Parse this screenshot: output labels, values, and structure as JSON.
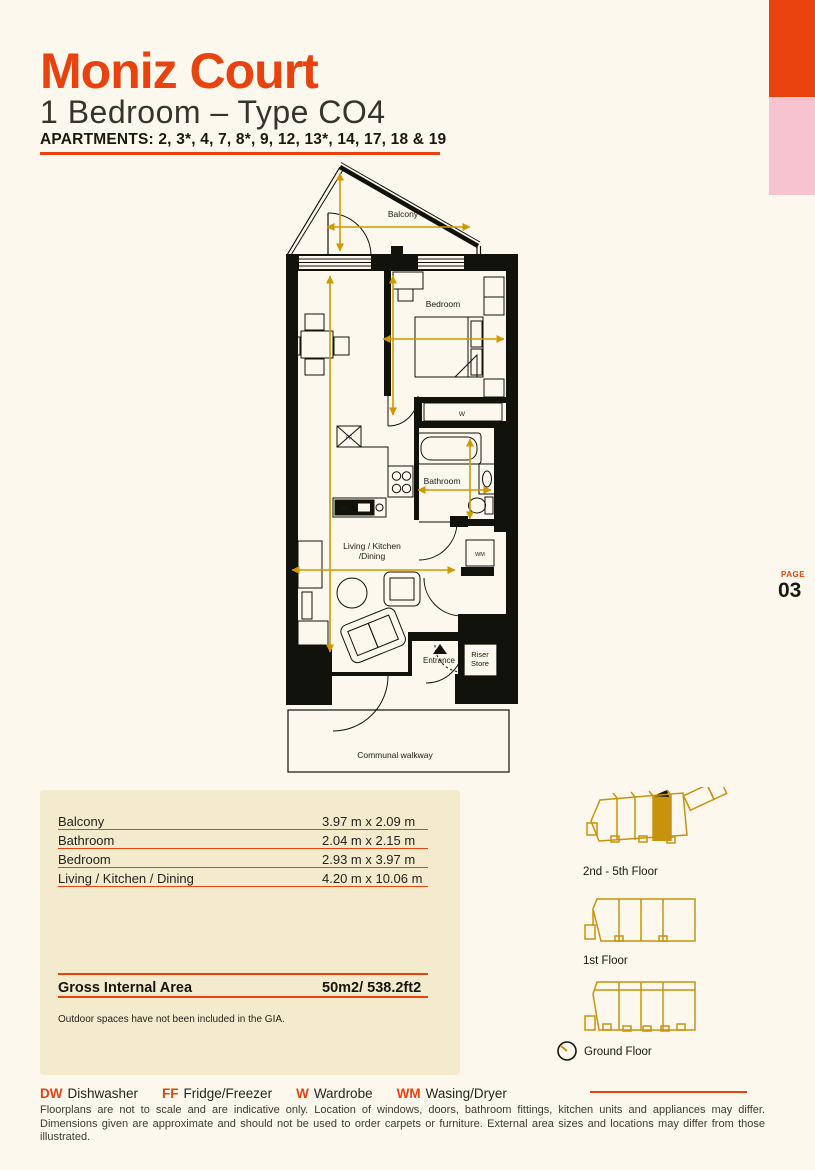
{
  "header": {
    "title": "Moniz Court",
    "subtitle": "1 Bedroom – Type CO4",
    "apartments": "APARTMENTS: 2, 3*, 4, 7, 8*, 9, 12, 13*, 14, 17, 18 & 19"
  },
  "page_marker": {
    "label": "PAGE",
    "number": "03"
  },
  "plan_labels": {
    "balcony": "Balcony",
    "bedroom": "Bedroom",
    "bathroom": "Bathroom",
    "living_line1": "Living / Kitchen",
    "living_line2": "/Dining",
    "entrance": "Entrance",
    "riser_line1": "Riser",
    "riser_line2": "Store",
    "walkway": "Communal walkway",
    "wardrobe": "W",
    "washer": "WM",
    "fridge": "FF",
    "dishwasher": "DW"
  },
  "dimensions_table": {
    "rows": [
      {
        "name": "Balcony",
        "size": "3.97 m x 2.09 m"
      },
      {
        "name": "Bathroom",
        "size": "2.04 m x 2.15 m"
      },
      {
        "name": "Bedroom",
        "size": "2.93 m x 3.97 m"
      },
      {
        "name": "Living / Kitchen / Dining",
        "size": "4.20 m x 10.06 m"
      }
    ],
    "gia_label": "Gross Internal Area",
    "gia_value": "50m2/ 538.2ft2",
    "note": "Outdoor spaces have not been included in the GIA."
  },
  "locators": {
    "upper": "2nd - 5th Floor",
    "first": "1st Floor",
    "ground": "Ground Floor"
  },
  "legend": {
    "items": [
      {
        "abbr": "DW",
        "name": "Dishwasher"
      },
      {
        "abbr": "FF",
        "name": "Fridge/Freezer"
      },
      {
        "abbr": "W",
        "name": "Wardrobe"
      },
      {
        "abbr": "WM",
        "name": "Wasing/Dryer"
      }
    ]
  },
  "disclaimer": "Floorplans are not to scale and are indicative only. Location of windows, doors, bathroom fittings, kitchen units and appliances may differ. Dimensions given are approximate and should not be used to order carpets or furniture. External area sizes and locations may differ from those illustrated.",
  "colors": {
    "accent": "#e8430f",
    "pink": "#f6c3cf",
    "dimension_gold": "#d09902",
    "locator_gold": "#c9920c",
    "table_bg": "#f4ebcf",
    "page_bg": "#fcf8ed",
    "ink": "#17170f"
  }
}
